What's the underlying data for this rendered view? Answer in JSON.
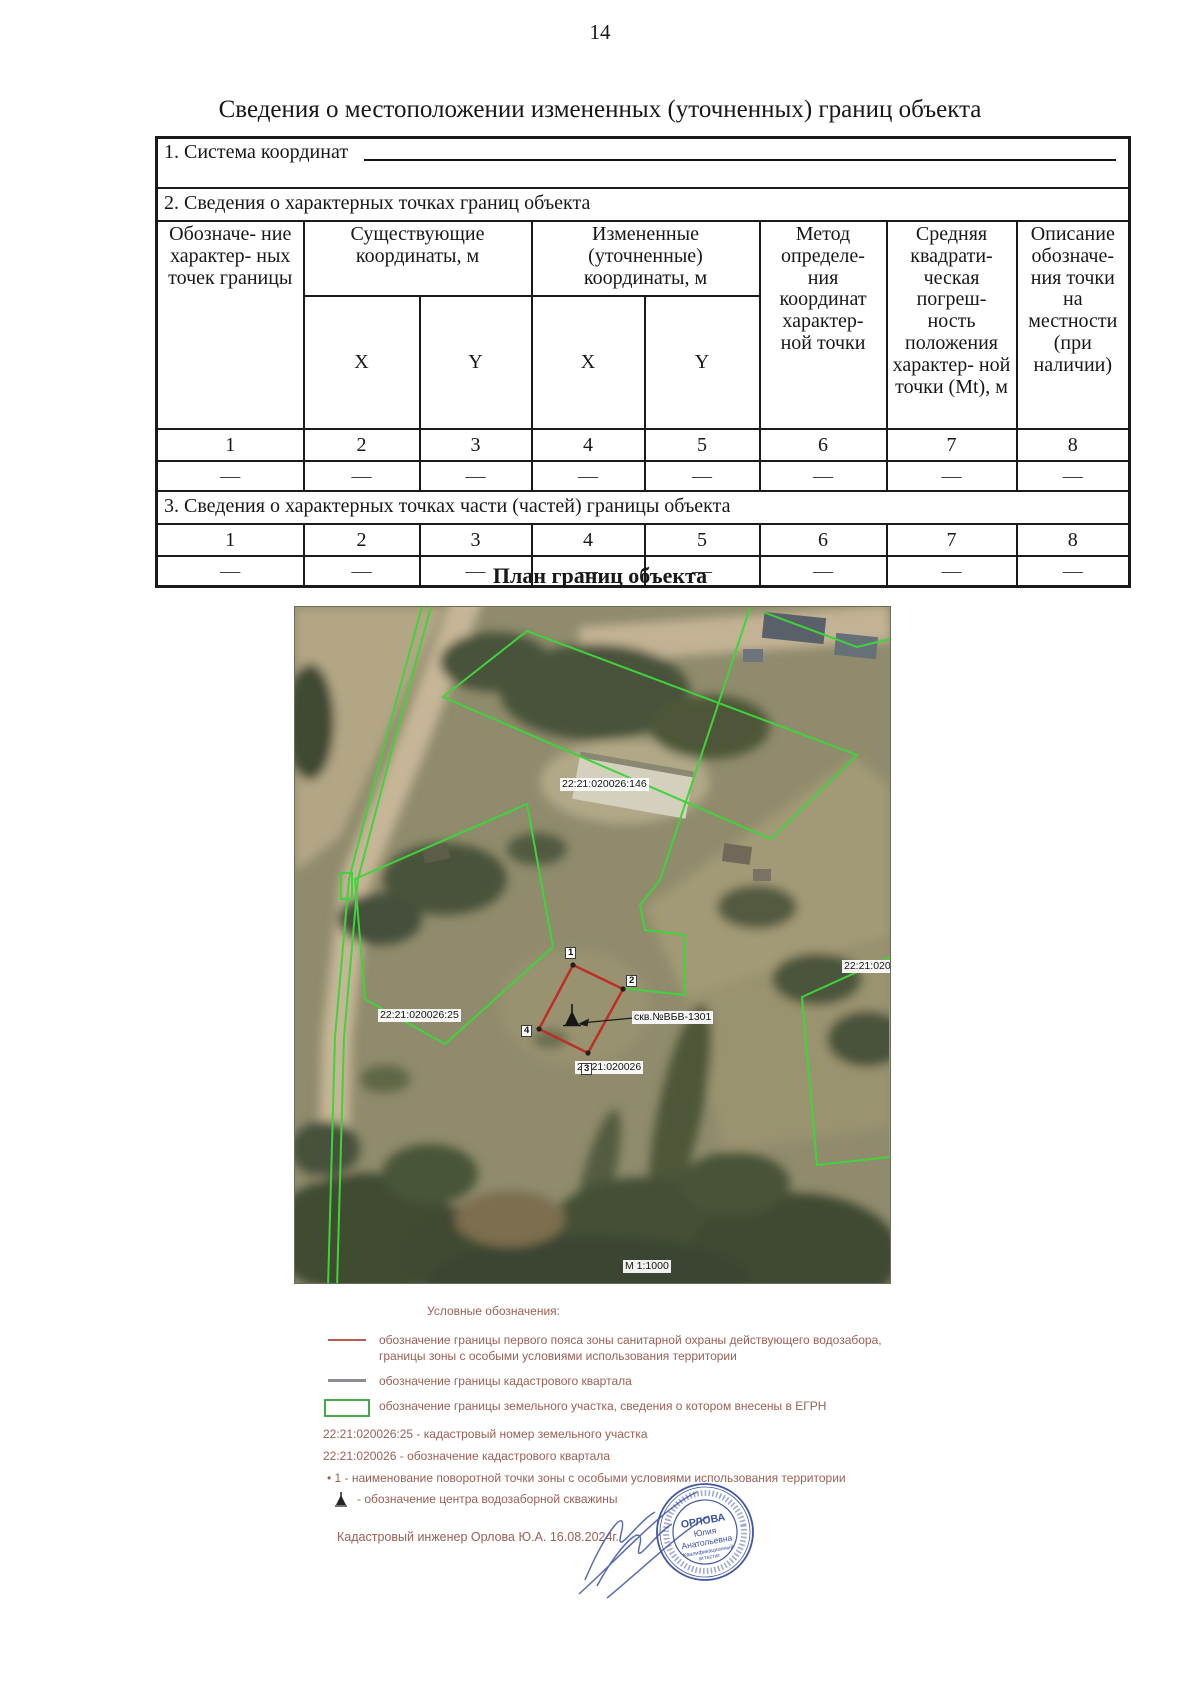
{
  "page_number": "14",
  "title": "Сведения о местоположении измененных (уточненных) границ объекта",
  "table": {
    "section1": "1. Система координат",
    "section2": "2. Сведения о характерных точках границ объекта",
    "section3": "3. Сведения о характерных точках части (частей) границы объекта",
    "headers": {
      "point": "Обозначе- ние характер- ных точек границы",
      "existing": "Существующие координаты, м",
      "changed": "Измененные (уточненные) координаты, м",
      "x": "X",
      "y": "Y",
      "method": "Метод определе- ния координат характер- ной точки",
      "error": "Средняя квадрати- ческая погреш- ность положения характер- ной точки (Mt), м",
      "description": "Описание обозначе- ния точки на местности (при наличии)"
    },
    "column_numbers": [
      "1",
      "2",
      "3",
      "4",
      "5",
      "6",
      "7",
      "8"
    ],
    "placeholder_row": [
      "—",
      "—",
      "—",
      "—",
      "—",
      "—",
      "—",
      "—"
    ]
  },
  "plan": {
    "heading": "План границ объекта",
    "scale": "М 1:1000",
    "labels": {
      "parcel_146": "22:21:020026:146",
      "parcel_395": "22:21:020026:395",
      "parcel_25": "22:21:020026:25",
      "quarter": "22:21:020026",
      "well": "скв.№ВБВ-1301"
    },
    "points": [
      "1",
      "2",
      "3",
      "4"
    ]
  },
  "legend": {
    "title": "Условные обозначения:",
    "red_line_text_1": "обозначение границы первого пояса зоны санитарной охраны действующего водозабора,",
    "red_line_text_2": "границы зоны с особыми условиями использования территории",
    "gray_line_text": "обозначение границы кадастрового квартала",
    "green_rect_text": "обозначение границы земельного участка, сведения о котором внесены в ЕГРН",
    "parcel_note": "22:21:020026:25 - кадастровый номер земельного участка",
    "quarter_note": "22:21:020026 - обозначение кадастрового квартала",
    "point_note": "• 1 - наименование поворотной точки зоны с особыми условиями использования территории",
    "well_note": "- обозначение центра водозаборной скважины"
  },
  "engineer_line": "Кадастровый инженер Орлова Ю.А. 16.08.2024г.",
  "stamp": {
    "line1": "ОРЛОВА",
    "line2": "Юлия",
    "line3": "Анатольевна",
    "line4": "Квалификационный",
    "line5": "аттестат"
  }
}
